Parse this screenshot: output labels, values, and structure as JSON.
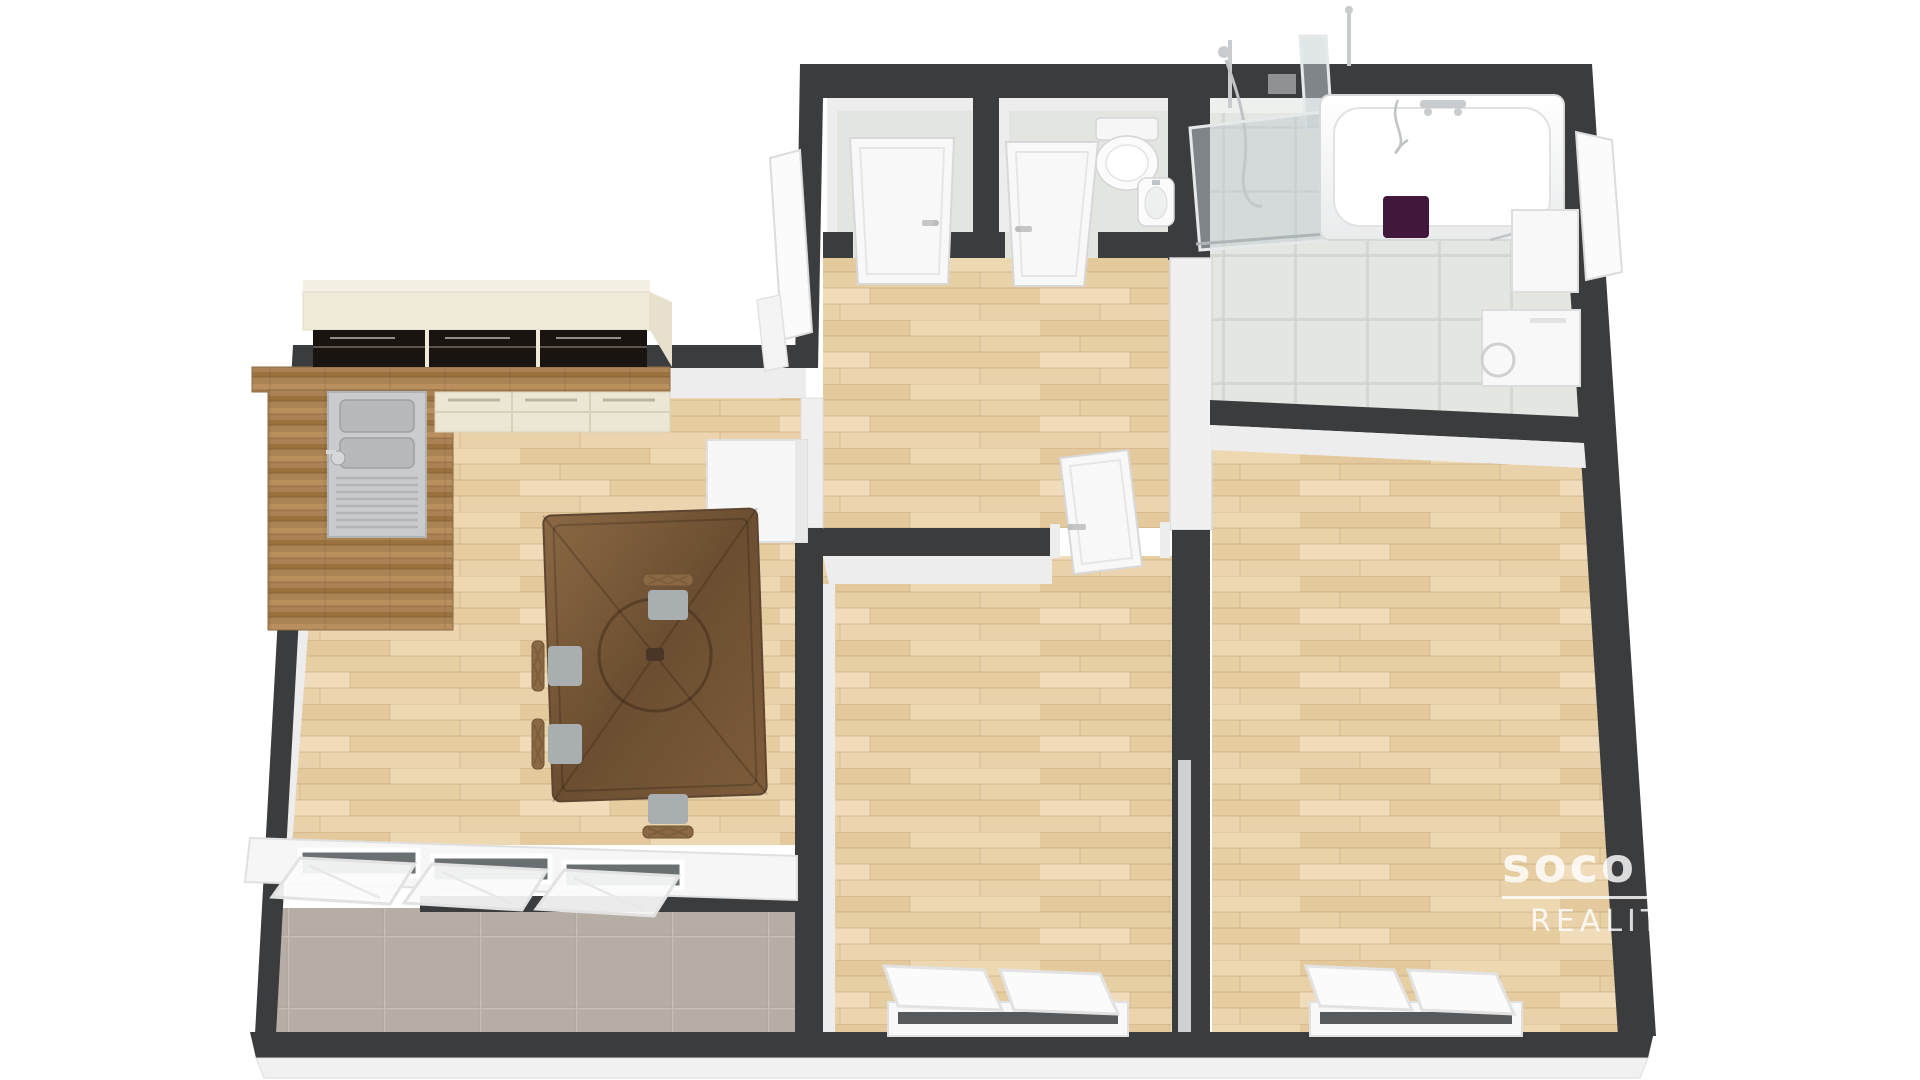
{
  "watermark": {
    "brand": "soco",
    "tagline": "REALITY"
  },
  "scene": {
    "type": "3d-floor-plan-render",
    "view": "isometric top-down apartment",
    "rooms": [
      {
        "name": "kitchen-living-room",
        "items": [
          "cream upper cabinets",
          "black gloss cabinet fronts",
          "wood countertop L",
          "stainless double sink with drainer",
          "cream drawer base units",
          "white cabinet",
          "dark walnut dining table",
          "four lattice-back chairs with gray cushions"
        ]
      },
      {
        "name": "hallway",
        "items": [
          "open white entrance door"
        ]
      },
      {
        "name": "storage-room",
        "items": [
          "white door"
        ]
      },
      {
        "name": "wc",
        "items": [
          "toilet",
          "corner washbasin",
          "white door"
        ]
      },
      {
        "name": "bathroom",
        "items": [
          "bathtub with chrome mixer",
          "hand shower",
          "glass shower panels",
          "dark purple towel",
          "white cabinet with open door",
          "washing machine"
        ]
      },
      {
        "name": "bedroom-1",
        "items": [
          "open white door",
          "tilted open window"
        ]
      },
      {
        "name": "bedroom-2",
        "items": [
          "tilted open window"
        ]
      },
      {
        "name": "balcony",
        "items": [
          "gray tile floor",
          "row of tilted open windows"
        ]
      }
    ]
  },
  "colors": {
    "wall": "#3a3c3e",
    "wall_face": "#ededed",
    "wall_face_dim": "#dedede",
    "wood": "#e9d2aa",
    "wood_line": "#d6b88c",
    "counter": "#ab8254",
    "cream": "#efead9",
    "black_gloss": "#1a1410",
    "tile_bath": "#e4e6e2",
    "tile_balcony": "#b2aaa0",
    "steel": "#c9ccce",
    "glass": "#c4cdd2",
    "towel": "#41173c",
    "table": "#7b5a39",
    "chair_wood": "#8a6a44",
    "cushion": "#a9aeb1",
    "white_fixture": "#fafafa",
    "watermark": "#ffffff"
  }
}
